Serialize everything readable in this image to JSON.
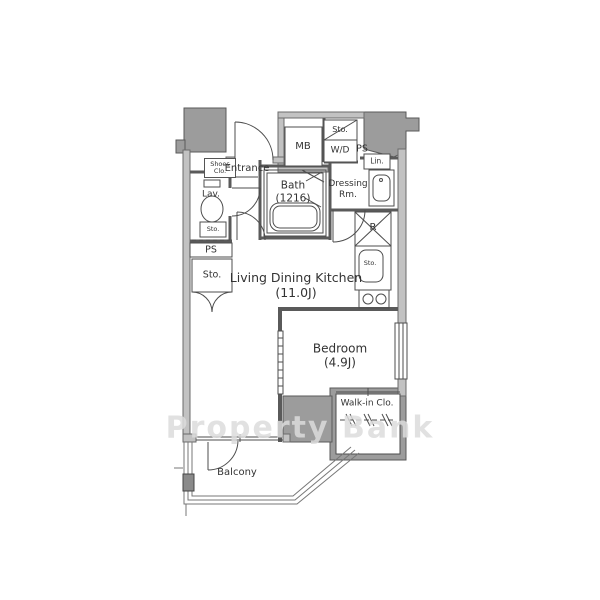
{
  "watermark": "Property Bank",
  "colors": {
    "wall_light_fill": "#c2c2c2",
    "pillar_fill": "#9c9c9c",
    "line": "#4d4d4d",
    "text": "#333333",
    "watermark_color": "#dcdcdc"
  },
  "rooms": {
    "ldk": {
      "name": "Living Dining Kitchen",
      "size": "(11.0J)"
    },
    "bedroom": {
      "name": "Bedroom",
      "size": "(4.9J)"
    },
    "bath": {
      "name": "Bath",
      "size": "(1216)"
    },
    "dressing": {
      "line1": "Dressing",
      "line2": "Rm."
    },
    "lav": "Lav.",
    "entrance": "Entrance",
    "balcony": "Balcony",
    "walk_in_closet": "Walk-in Clo."
  },
  "labels": {
    "shoes_closet_line1": "Shoes",
    "shoes_closet_line2": "Clo.",
    "meter_box": "MB",
    "storage_over_wd": "Sto.",
    "washer_dryer": "W/D",
    "pipe_space_top": "PS",
    "pipe_space_left": "PS",
    "linen": "Lin.",
    "storage_hall": "Sto.",
    "storage_toilet": "Sto.",
    "storage_kitchen": "Sto.",
    "refrigerator": "R"
  }
}
